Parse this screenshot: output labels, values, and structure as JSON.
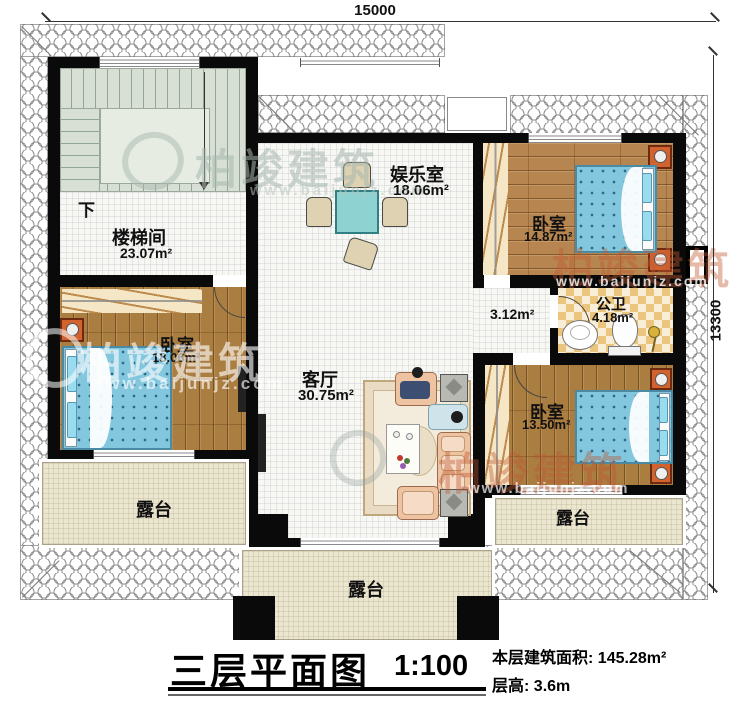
{
  "dimensions": {
    "top": "15000",
    "right": "13300"
  },
  "stairwell": {
    "name": "楼梯间",
    "area": "23.07m²",
    "down_label": "下"
  },
  "entertainment": {
    "name": "娱乐室",
    "area": "18.06m²"
  },
  "bedroom_top_right": {
    "name": "卧室",
    "area": "14.87m²"
  },
  "bathroom": {
    "name": "公卫",
    "area": "4.18m²"
  },
  "hallway": {
    "area": "3.12m²"
  },
  "bedroom_left": {
    "name": "卧室",
    "area": "18.06m²"
  },
  "living_room": {
    "name": "客厅",
    "area": "30.75m²"
  },
  "bedroom_bottom_right": {
    "name": "卧室",
    "area": "13.50m²"
  },
  "terrace_bottom_left": {
    "name": "露台"
  },
  "terrace_bottom_center": {
    "name": "露台"
  },
  "terrace_bottom_right": {
    "name": "露台"
  },
  "title_block": {
    "title": "三层平面图",
    "scale": "1:100",
    "area_label": "本层建筑面积:",
    "area_value": "145.28m²",
    "floor_height_label": "层高:",
    "floor_height_value": "3.6m"
  },
  "watermark": {
    "brand": "柏竣建筑",
    "url": "www.baijunjz.com"
  },
  "colors": {
    "wall": "#0a0a0a",
    "wood_floor": "#b78650",
    "bed": "#83c7df",
    "table": "#8ed2d2",
    "terrace": "#ebe6cf",
    "stairs": "#d8dfd4",
    "bathroom_tile": "#ebc47d",
    "watermark_red": "#c05a32"
  }
}
